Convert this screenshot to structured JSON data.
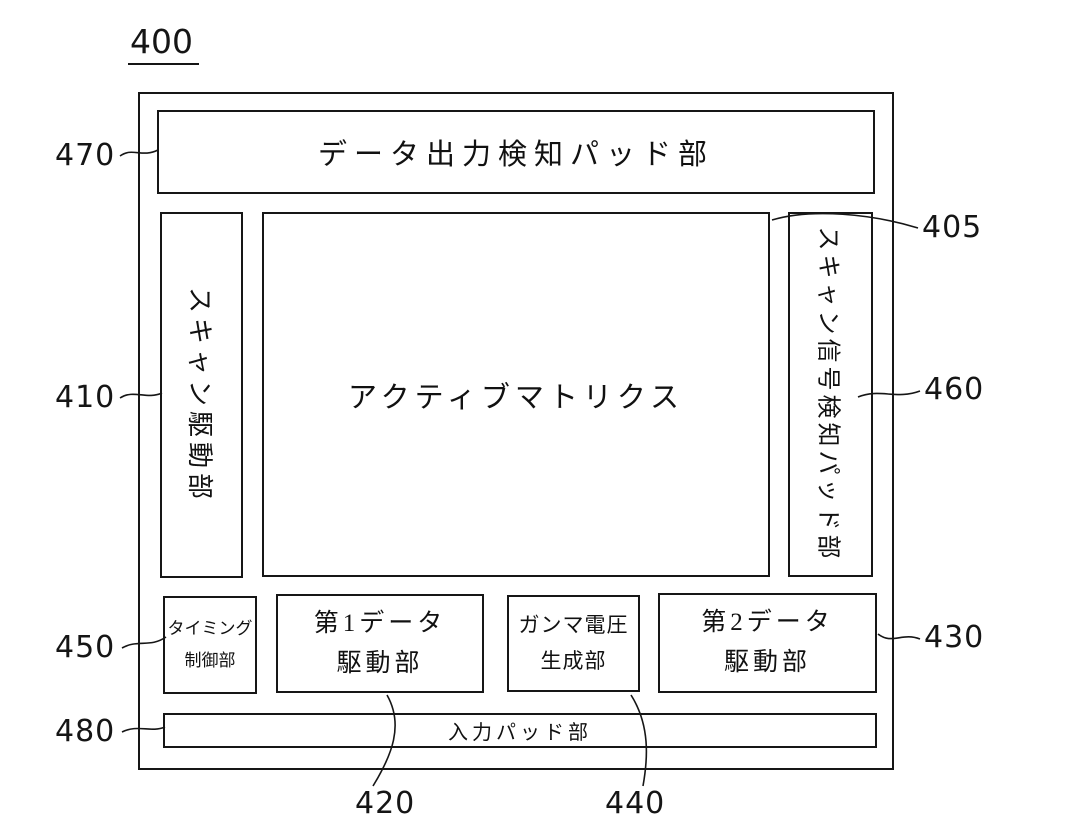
{
  "figure": {
    "number": "400",
    "type": "patent-block-diagram",
    "blocks": {
      "data_output_pad": {
        "label": "データ出力検知パッド部",
        "ref": "470"
      },
      "scan_driver": {
        "label": "スキャン駆動部",
        "ref": "410"
      },
      "active_matrix": {
        "label": "アクティブマトリクス",
        "ref": "405"
      },
      "scan_signal_pad": {
        "label": "スキャン信号検知パッド部",
        "ref": "460"
      },
      "timing_controller": {
        "line1": "タイミング",
        "line2": "制御部",
        "ref": "450"
      },
      "first_data_driver": {
        "line1": "第1データ",
        "line2": "駆動部",
        "ref": "420"
      },
      "gamma_generator": {
        "line1": "ガンマ電圧",
        "line2": "生成部",
        "ref": "440"
      },
      "second_data_driver": {
        "line1": "第2データ",
        "line2": "駆動部",
        "ref": "430"
      },
      "input_pad": {
        "label": "入力パッド部",
        "ref": "480"
      }
    },
    "refs": {
      "400": "400",
      "405": "405",
      "410": "410",
      "420": "420",
      "430": "430",
      "440": "440",
      "450": "450",
      "460": "460",
      "470": "470",
      "480": "480"
    },
    "colors": {
      "line": "#161616",
      "background": "#ffffff"
    }
  }
}
